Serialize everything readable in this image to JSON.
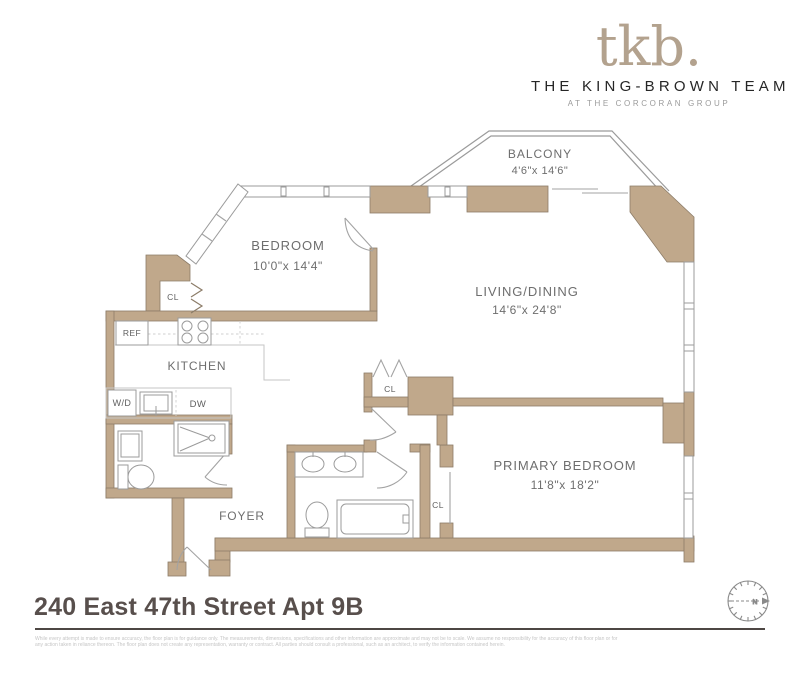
{
  "header": {
    "logo_text": "tkb.",
    "team_name": "THE KING-BROWN TEAM",
    "team_subtitle": "AT THE CORCORAN GROUP"
  },
  "floorplan": {
    "rooms": {
      "balcony": {
        "name": "BALCONY",
        "dims": "4'6\"x 14'6\""
      },
      "bedroom": {
        "name": "BEDROOM",
        "dims": "10'0\"x 14'4\""
      },
      "living_dining": {
        "name": "LIVING/DINING",
        "dims": "14'6\"x 24'8\""
      },
      "kitchen": {
        "name": "KITCHEN"
      },
      "foyer": {
        "name": "FOYER"
      },
      "primary_bedroom": {
        "name": "PRIMARY BEDROOM",
        "dims": "11'8\"x 18'2\""
      }
    },
    "labels": {
      "closet": "CL",
      "refrigerator": "REF",
      "washer_dryer": "W/D",
      "dishwasher": "DW"
    },
    "compass": {
      "north_label": "N"
    }
  },
  "footer": {
    "address": "240 East 47th Street Apt 9B",
    "disclaimer": "While every attempt is made to ensure accuracy, the floor plan is for guidance only. The measurements, dimensions, specifications and other information are approximate and may not be to scale. We assume no responsibility for the accuracy of this floor plan or for any action taken in reliance thereon. The floor plan does not create any representation, warranty or contract. All parties should consult a professional, such as an architect, to verify the information contained herein."
  },
  "colors": {
    "wall_fill": "#c0a88b",
    "wall_stroke": "#8c7c68",
    "line_gray": "#9b9b9b",
    "label_gray": "#6e6e6e",
    "logo_beige": "#b3a28e",
    "title_color": "#584f4c"
  }
}
